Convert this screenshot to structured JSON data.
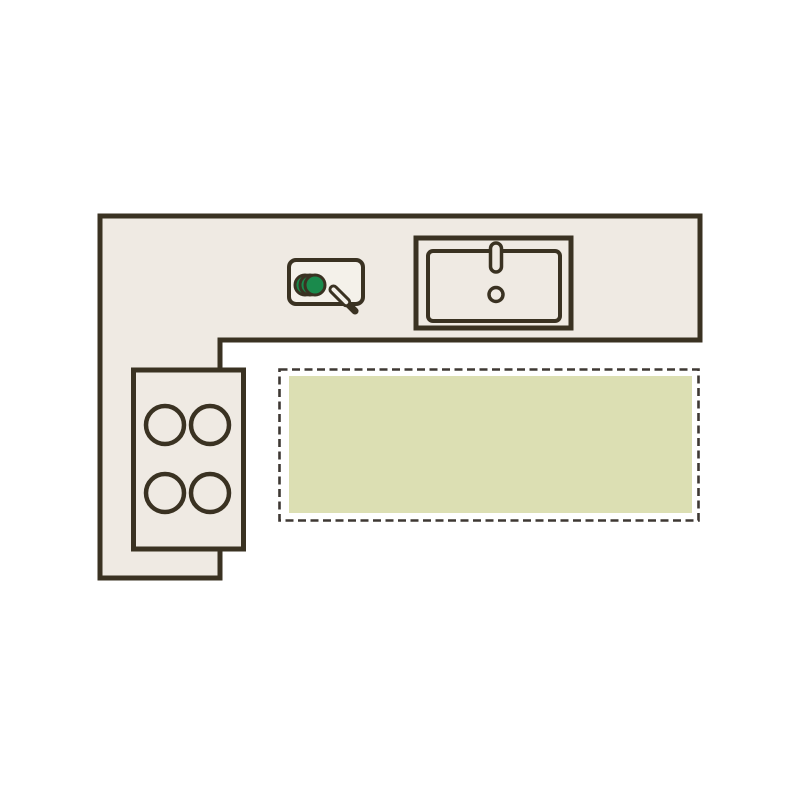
{
  "diagram": {
    "kind": "kitchen-floor-plan",
    "colors": {
      "background": "#ffffff",
      "outline": "#3a3222",
      "counter_fill": "#efeae3",
      "board_fill": "#f4f1ea",
      "vegetable_green": "#1a8a4c",
      "zone_fill": "#dcdfb3",
      "zone_border": "#3e3833"
    },
    "counter": {
      "shape": "l-shape"
    },
    "stove": {
      "burner_count": 4
    },
    "sink": {
      "has_faucet": true,
      "has_drain": true
    },
    "cutting_board": {
      "slice_count": 3,
      "has_knife": true
    },
    "placement_zone": {
      "style": "dashed",
      "highlighted": true
    }
  }
}
